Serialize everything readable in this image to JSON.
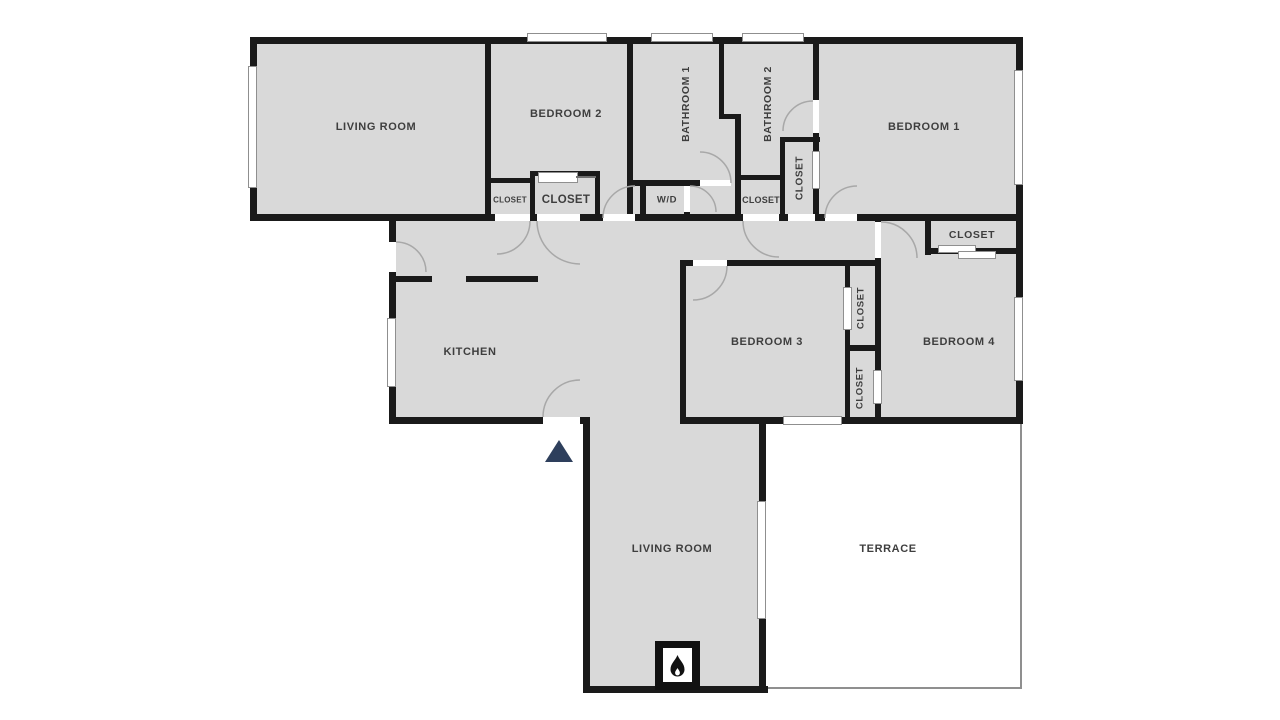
{
  "labels": {
    "living_room_top": "LIVING ROOM",
    "bedroom_2": "BEDROOM 2",
    "bathroom_1": "BATHROOM 1",
    "bathroom_2": "BATHROOM 2",
    "bedroom_1": "BEDROOM 1",
    "closet_hall_small": "CLOSET",
    "closet_hall_large": "CLOSET",
    "wd": "W/D",
    "closet_hall_2": "CLOSET",
    "closet_bedroom1_vertical": "CLOSET",
    "closet_bedroom1": "CLOSET",
    "kitchen": "KITCHEN",
    "bedroom_3": "BEDROOM 3",
    "bedroom_4": "BEDROOM 4",
    "closet_bedroom3": "CLOSET",
    "closet_bedroom4": "CLOSET",
    "living_room_bottom": "LIVING ROOM",
    "terrace": "TERRACE"
  },
  "colors": {
    "wall": "#1a1a1a",
    "floor": "#d9d9d9",
    "label": "#3e3e3e",
    "north_arrow": "#2e3f5c",
    "door_arc": "#a8a8a8",
    "flame": "#111111"
  },
  "icons": {
    "north_arrow": "triangle-up",
    "fireplace": "flame"
  }
}
